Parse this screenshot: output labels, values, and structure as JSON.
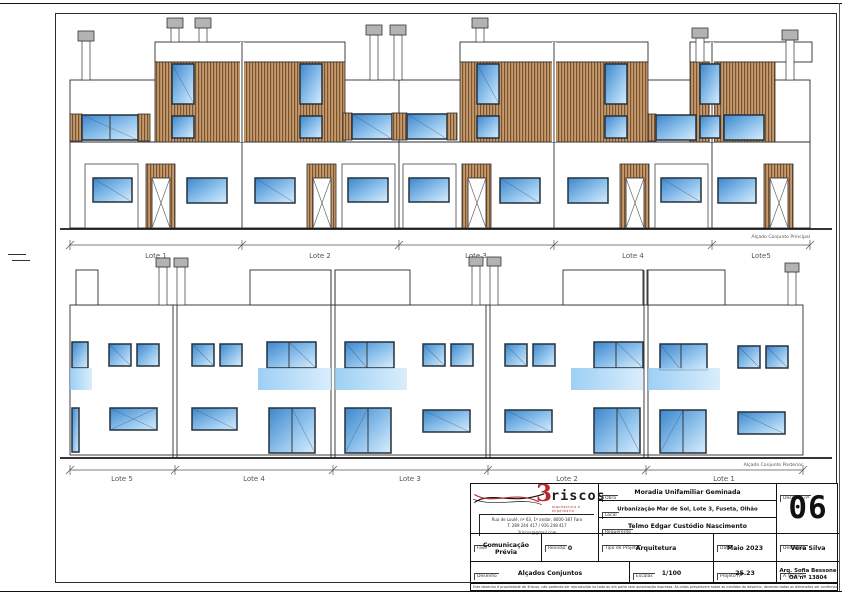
{
  "sheet": {
    "principal": {
      "label": "Alçado Conjunto Principal",
      "lots": [
        "Lote 1",
        "Lote 2",
        "Lote 3",
        "Lote 4",
        "Lote5"
      ]
    },
    "posterior": {
      "label": "Alçado Conjunto Posterior",
      "lots": [
        "Lote 5",
        "Lote 4",
        "Lote 3",
        "Lote 2",
        "Lote 1"
      ]
    }
  },
  "title_block": {
    "logo": {
      "number": "3",
      "name": "riscos",
      "tagline": "arquitectura e engenharia",
      "address_line1": "Rua de Loulé, nº 63, 1º andar, 8000-387 Faro",
      "address_line2": "T. 289 244 417 / 916 248 417",
      "address_line3": "3riscos@gmail.com"
    },
    "fields": {
      "obra": {
        "label": "Obra",
        "value": "Moradia Unifamiliar Geminada"
      },
      "local": {
        "label": "Local",
        "value": "Urbanização Mar de Sol, Lote 3, Fuseta, Olhão"
      },
      "requerente": {
        "label": "Requerente",
        "value": "Telmo Edgar Custódio Nascimento"
      },
      "fase": {
        "label": "Fase",
        "value": "Comunicação Prévia"
      },
      "revisao": {
        "label": "Revisão",
        "value": "0"
      },
      "tipo": {
        "label": "Tipo de Projeto",
        "value": "Arquitetura"
      },
      "data": {
        "label": "Data",
        "value": "Maio 2023"
      },
      "desenhou": {
        "label": "Desenhou",
        "value": "Vera Silva"
      },
      "desenho": {
        "label": "Desenho",
        "value": "Alçados Conjuntos"
      },
      "escalas": {
        "label": "Escalas",
        "value": "1/100"
      },
      "projeto_n": {
        "label": "Projeto nº",
        "value": "25.23"
      },
      "tecnica": {
        "label": "A Técnica",
        "value": "Arq. Sofia Bessone",
        "value2": "OA nº 13804"
      },
      "desenho_n": {
        "label": "Desenho nº",
        "value": "06"
      }
    },
    "disclaimer": "Este desenho é propriedade da 3riscos, não podendo ser reproduzido no todo ou em parte sem autorização expressa. As cotas prevalecem sobre as medidas do desenho, devendo todas as dimensões ser confirmadas em obra segundo o Dec. Lei 176/98 de 3 de Julho."
  },
  "colors": {
    "glass_blue": "#4a8fd3",
    "glass_light": "#d7ecfb",
    "wood_brown": "#c69a6d",
    "wood_dark": "#7a5430",
    "balcony_blue": "#9fd0f3",
    "logo_red": "#b5282b",
    "line_dark": "#222222"
  }
}
